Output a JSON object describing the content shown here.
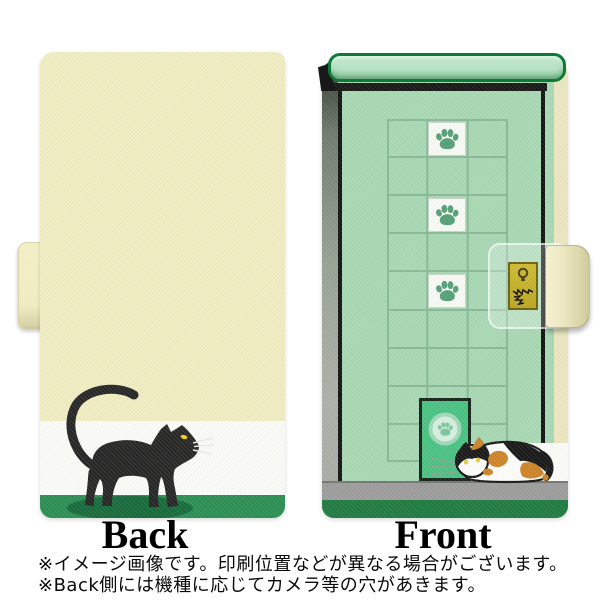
{
  "labels": {
    "back": "Back",
    "front": "Front"
  },
  "notes": {
    "line1": "※イメージ画像です。印刷位置などが異なる場合がございます。",
    "line2": "※Back側には機種に応じてカメラ等の穴があきます。"
  },
  "product": {
    "kind": "notebook-style flip phone case, two-view product image",
    "back_design": "black cat walking with raised tail on green ground band, white wall band, cream wall",
    "front_design": "mint green door with 3x9 tile grid, 3 white paw-print tiles, scratched gold lock plate with keyhole, green pet door with paw emblem, calico cat crouching by the pet door",
    "paw_tile_count": 3
  },
  "icons": {
    "paw_tiles": "paw-print-icon",
    "pet_door_emblem": "paw-print-icon",
    "lock": "keyhole-icon",
    "scratches": "scratch-marks-icon"
  },
  "colors": {
    "back_cream": "#f1edc2",
    "wall_white": "#fbfbf8",
    "back_grass_green": "#2b8e54",
    "cat_black": "#262626",
    "cat_eye_yellow": "#f2cf0a",
    "cat_shadow_green": "#176a3b",
    "front_mint": "#a8d8b4",
    "top_bar_mint": "#b6e3c3",
    "top_bar_border_green": "#0d7a37",
    "grid_line_green": "#87b996",
    "tile_white": "#f8faf6",
    "paw_green": "#55a077",
    "pet_door_green": "#49c282",
    "pet_door_disc": "#d7efe1",
    "lock_gold": "#c6b42c",
    "floor_gray": "#9c9c9c",
    "front_base_green": "#1f7a42",
    "edge_cream": "#ece7c0",
    "calico_orange": "#cd8427"
  }
}
